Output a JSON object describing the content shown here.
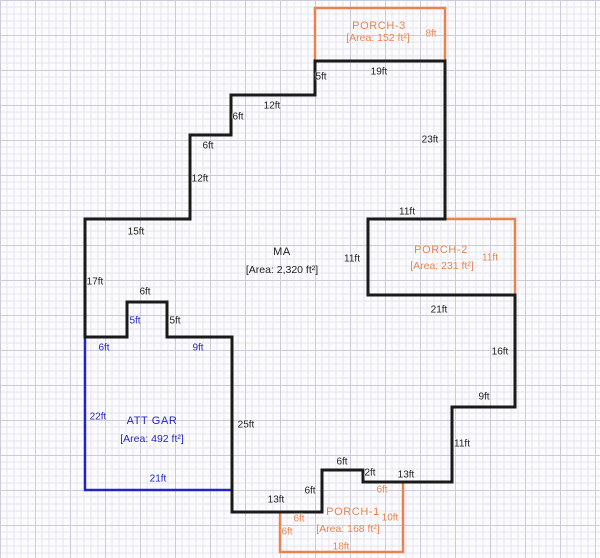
{
  "colors": {
    "wall_black": "#1a1a1a",
    "garage_blue": "#2323c3",
    "porch_orange": "#e8824e",
    "grid_minor": "#e4e4ef",
    "grid_major": "#cbcbdc",
    "paper": "#fcfcfe"
  },
  "rooms": [
    {
      "id": "ma",
      "name": "MA",
      "area": "[Area: 2,320 ft²]",
      "color": "black",
      "name_pos": {
        "x": 282,
        "y": 252
      },
      "area_pos": {
        "x": 282,
        "y": 270
      }
    },
    {
      "id": "att-gar",
      "name": "ATT GAR",
      "area": "[Area: 492 ft²]",
      "color": "blue",
      "name_pos": {
        "x": 152,
        "y": 421
      },
      "area_pos": {
        "x": 152,
        "y": 439
      }
    },
    {
      "id": "porch-1",
      "name": "PORCH-1",
      "area": "[Area: 168 ft²]",
      "color": "orange",
      "name_pos": {
        "x": 353,
        "y": 512
      },
      "area_pos": {
        "x": 348,
        "y": 529
      }
    },
    {
      "id": "porch-2",
      "name": "PORCH-2",
      "area": "[Area: 231 ft²]",
      "color": "orange",
      "name_pos": {
        "x": 441,
        "y": 250
      },
      "area_pos": {
        "x": 442,
        "y": 266
      }
    },
    {
      "id": "porch-3",
      "name": "PORCH-3",
      "area": "[Area: 152 ft²]",
      "color": "orange",
      "name_pos": {
        "x": 379,
        "y": 26
      },
      "area_pos": {
        "x": 378,
        "y": 38
      }
    }
  ],
  "dimensions": [
    {
      "text": "5ft",
      "x": 321,
      "y": 77,
      "color": "black"
    },
    {
      "text": "19ft",
      "x": 379,
      "y": 72,
      "color": "black"
    },
    {
      "text": "23ft",
      "x": 430,
      "y": 140,
      "color": "black"
    },
    {
      "text": "12ft",
      "x": 272,
      "y": 106,
      "color": "black"
    },
    {
      "text": "6ft",
      "x": 238,
      "y": 117,
      "color": "black"
    },
    {
      "text": "6ft",
      "x": 208,
      "y": 146,
      "color": "black"
    },
    {
      "text": "12ft",
      "x": 200,
      "y": 179,
      "color": "black"
    },
    {
      "text": "15ft",
      "x": 136,
      "y": 232,
      "color": "black"
    },
    {
      "text": "17ft",
      "x": 95,
      "y": 282,
      "color": "black"
    },
    {
      "text": "11ft",
      "x": 407,
      "y": 212,
      "color": "black"
    },
    {
      "text": "11ft",
      "x": 352,
      "y": 259,
      "color": "black"
    },
    {
      "text": "21ft",
      "x": 439,
      "y": 310,
      "color": "black"
    },
    {
      "text": "16ft",
      "x": 500,
      "y": 352,
      "color": "black"
    },
    {
      "text": "9ft",
      "x": 484,
      "y": 397,
      "color": "black"
    },
    {
      "text": "11ft",
      "x": 462,
      "y": 444,
      "color": "black"
    },
    {
      "text": "13ft",
      "x": 406,
      "y": 475,
      "color": "black"
    },
    {
      "text": "2ft",
      "x": 370,
      "y": 473,
      "color": "black"
    },
    {
      "text": "6ft",
      "x": 342,
      "y": 462,
      "color": "black"
    },
    {
      "text": "6ft",
      "x": 310,
      "y": 491,
      "color": "black"
    },
    {
      "text": "13ft",
      "x": 276,
      "y": 500,
      "color": "black"
    },
    {
      "text": "25ft",
      "x": 246,
      "y": 425,
      "color": "black"
    },
    {
      "text": "6ft",
      "x": 145,
      "y": 292,
      "color": "black"
    },
    {
      "text": "5ft",
      "x": 175,
      "y": 321,
      "color": "black"
    },
    {
      "text": "5ft",
      "x": 135,
      "y": 321,
      "color": "blue"
    },
    {
      "text": "6ft",
      "x": 104,
      "y": 348,
      "color": "blue"
    },
    {
      "text": "9ft",
      "x": 198,
      "y": 348,
      "color": "blue"
    },
    {
      "text": "22ft",
      "x": 98,
      "y": 417,
      "color": "blue"
    },
    {
      "text": "21ft",
      "x": 158,
      "y": 479,
      "color": "blue"
    },
    {
      "text": "8ft",
      "x": 431,
      "y": 34,
      "color": "orange"
    },
    {
      "text": "11ft",
      "x": 490,
      "y": 258,
      "color": "orange"
    },
    {
      "text": "6ft",
      "x": 382,
      "y": 490,
      "color": "orange"
    },
    {
      "text": "10ft",
      "x": 390,
      "y": 518,
      "color": "orange"
    },
    {
      "text": "6ft",
      "x": 299,
      "y": 519,
      "color": "orange"
    },
    {
      "text": "6ft",
      "x": 287,
      "y": 532,
      "color": "orange"
    },
    {
      "text": "18ft",
      "x": 341,
      "y": 547,
      "color": "orange"
    }
  ]
}
